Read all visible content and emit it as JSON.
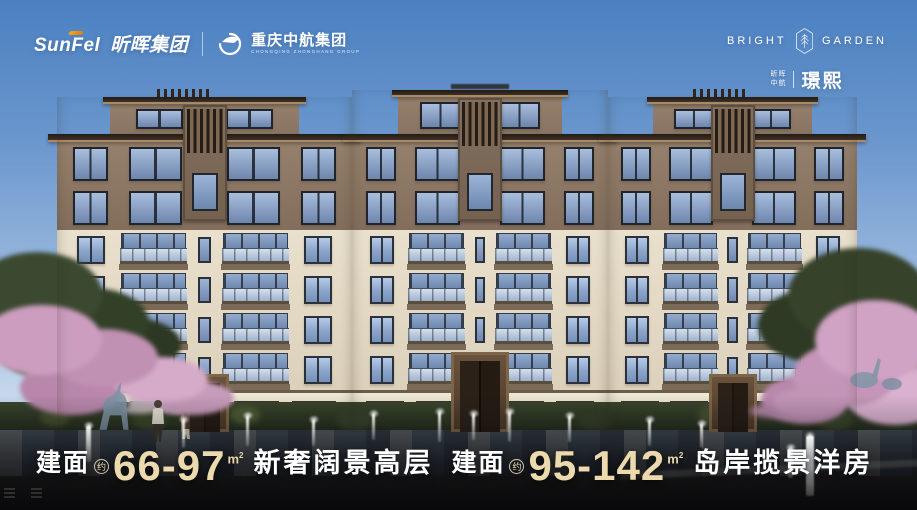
{
  "top_bar": {
    "sunfel_latin": "SunFel",
    "sunfel_cn": "昕晖集团",
    "separator": "|",
    "zhonghang_cn": "重庆中航集团",
    "zhonghang_en": "CHONGQING ZHONGHANG GROUP"
  },
  "brand_badge": {
    "en_left": "BRIGHT",
    "en_right": "GARDEN",
    "pair_top": "昕晖",
    "pair_bottom": "中航",
    "name_cn": "璟熙"
  },
  "taglines": {
    "left": {
      "label": "建面",
      "approx": "约",
      "range": "66-97",
      "unit_base": "m",
      "unit_sup": "2",
      "desc": "新奢阔景高层"
    },
    "right": {
      "label": "建面",
      "approx": "约",
      "range": "95-142",
      "unit_base": "m",
      "unit_sup": "2",
      "desc": "岛岸揽景洋房"
    }
  },
  "colors": {
    "sky_top": "#4b80c1",
    "sky_horizon": "#dde9f4",
    "facade_cream": "#e6ddc9",
    "facade_brown": "#8a7463",
    "eave_dark": "#342a21",
    "window_glass": "#8fa9cf",
    "accent_cream": "#ecd9ad",
    "accent_orange": "#ef9c1d",
    "blossom_pink": "#cc9dbf",
    "foliage_green": "#3b4930",
    "water_dark": "#2a323a"
  }
}
